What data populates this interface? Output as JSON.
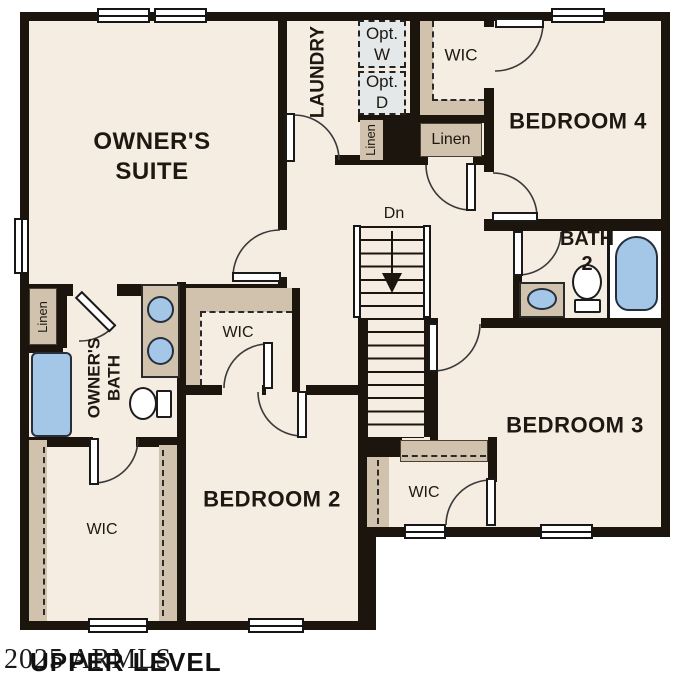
{
  "plan": {
    "labels": {
      "owners_suite": "OWNER'S SUITE",
      "laundry": "LAUNDRY",
      "opt_w": "Opt. W",
      "opt_d": "Opt. D",
      "linen_laundry": "Linen",
      "wic_bed4": "WIC",
      "linen_hall": "Linen",
      "bedroom4": "BEDROOM 4",
      "stairs_dn": "Dn",
      "bath2": "BATH 2",
      "bedroom3": "BEDROOM 3",
      "wic_bed3": "WIC",
      "bedroom2": "BEDROOM 2",
      "wic_hall": "WIC",
      "owners_bath": "OWNER'S BATH",
      "linen_owners": "Linen",
      "wic_owners": "WIC"
    },
    "footer": {
      "title": "UPPER LEVEL",
      "watermark": "2025 ARMLS"
    },
    "colors": {
      "floor": "#f5ece2",
      "wall": "#1c150d",
      "closet": "#d0c2ad",
      "fixture_blue": "#a5c7e7",
      "optional_fill": "#e4e8e9"
    }
  }
}
